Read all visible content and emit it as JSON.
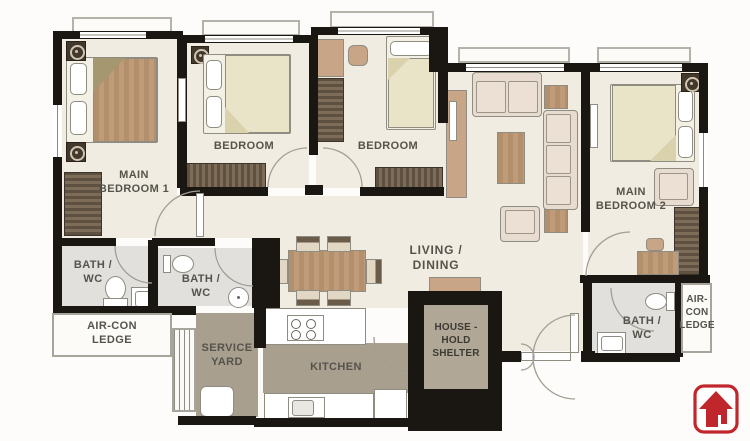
{
  "plan": {
    "labels": {
      "main_bedroom_1": {
        "l1": "MAIN",
        "l2": "BEDROOM 1"
      },
      "bedroom_left": {
        "l1": "BEDROOM"
      },
      "bedroom_mid": {
        "l1": "BEDROOM"
      },
      "main_bedroom_2": {
        "l1": "MAIN",
        "l2": "BEDROOM 2"
      },
      "living_dining": {
        "l1": "LIVING / DINING"
      },
      "bath_1": {
        "l1": "BATH /",
        "l2": "WC"
      },
      "bath_2": {
        "l1": "BATH /",
        "l2": "WC"
      },
      "bath_3": {
        "l1": "BATH /",
        "l2": "WC"
      },
      "aircon_ledge_left": {
        "l1": "AIR-CON",
        "l2": "LEDGE"
      },
      "aircon_ledge_right": {
        "l1": "AIR-",
        "l2": "CON",
        "l3": "LEDGE"
      },
      "service_yard": {
        "l1": "SERVICE",
        "l2": "YARD"
      },
      "kitchen": {
        "l1": "KITCHEN"
      },
      "household_shelter": {
        "l1": "HOUSE -",
        "l2": "HOLD",
        "l3": "SHELTER"
      }
    },
    "colors": {
      "wall": "#1a1713",
      "floor": "#f0ece1",
      "bath_floor": "#e1e0dc",
      "utility_floor": "#a99f8e",
      "shelter_floor": "#b1a797",
      "wood": "#b98f6e",
      "wardrobe": "#6f5f4d",
      "upholstery": "#e8dcd1",
      "bedding": "#e9e3c8",
      "label_text": "#55534b",
      "logo_red": "#c0272c"
    },
    "icons": [
      "aircon-unit-icon",
      "toilet-icon",
      "sink-icon",
      "stove-icon",
      "washer-icon",
      "house-arrow-logo-icon"
    ]
  }
}
